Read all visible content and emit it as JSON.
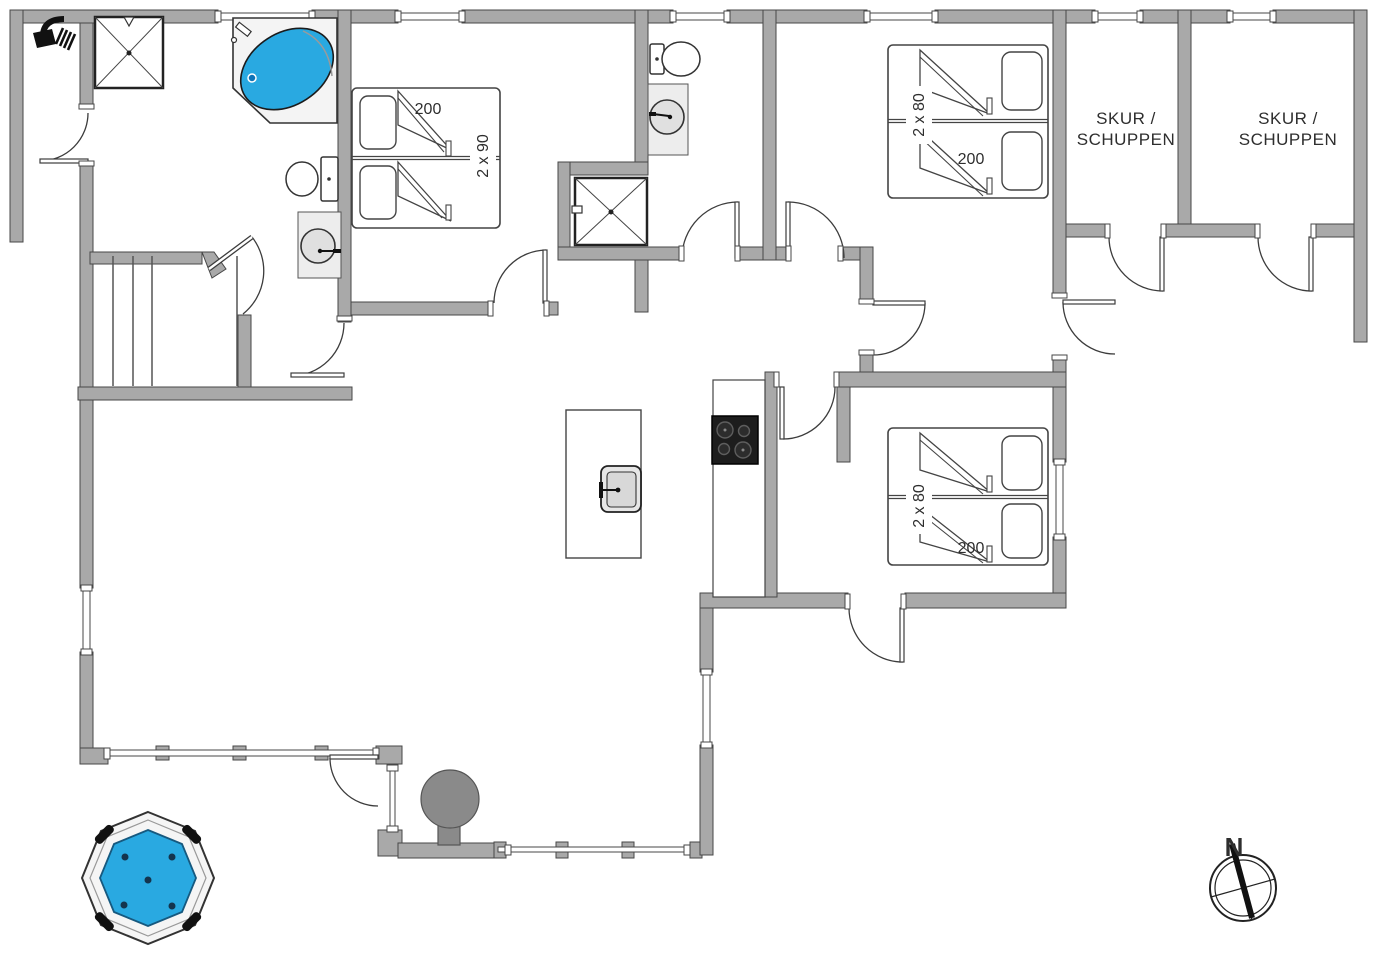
{
  "floorplan": {
    "kind": "holiday-house floor plan",
    "labels": {
      "shed1_line1": "SKUR /",
      "shed1_line2": "SCHUPPEN",
      "shed2_line1": "SKUR /",
      "shed2_line2": "SCHUPPEN",
      "compass_north": "N"
    },
    "beds": {
      "bedroom_top_left": {
        "width_label": "200",
        "size_label": "2 x 90"
      },
      "bedroom_top_right": {
        "width_label": "200",
        "size_label": "2 x 80"
      },
      "bedroom_mid_right": {
        "width_label": "200",
        "size_label": "2 x 80"
      }
    },
    "colors": {
      "wall": "#a9a9a9",
      "wall_outline": "#474747",
      "water": "#29a9e1",
      "counter": "#ededed",
      "stove": "#1d1d1d",
      "grill": "#8a8a8a",
      "icon": "#111111"
    },
    "fixtures": [
      "shower-icon",
      "shower-cabin",
      "corner-bathtub",
      "toilet",
      "washbasin",
      "toilet",
      "washbasin",
      "shower-cabin",
      "double-bed",
      "double-bed",
      "double-bed",
      "kitchen-island",
      "island-sink",
      "stove-cooktop",
      "outdoor-grill",
      "hot-tub",
      "compass",
      "stairs"
    ]
  }
}
